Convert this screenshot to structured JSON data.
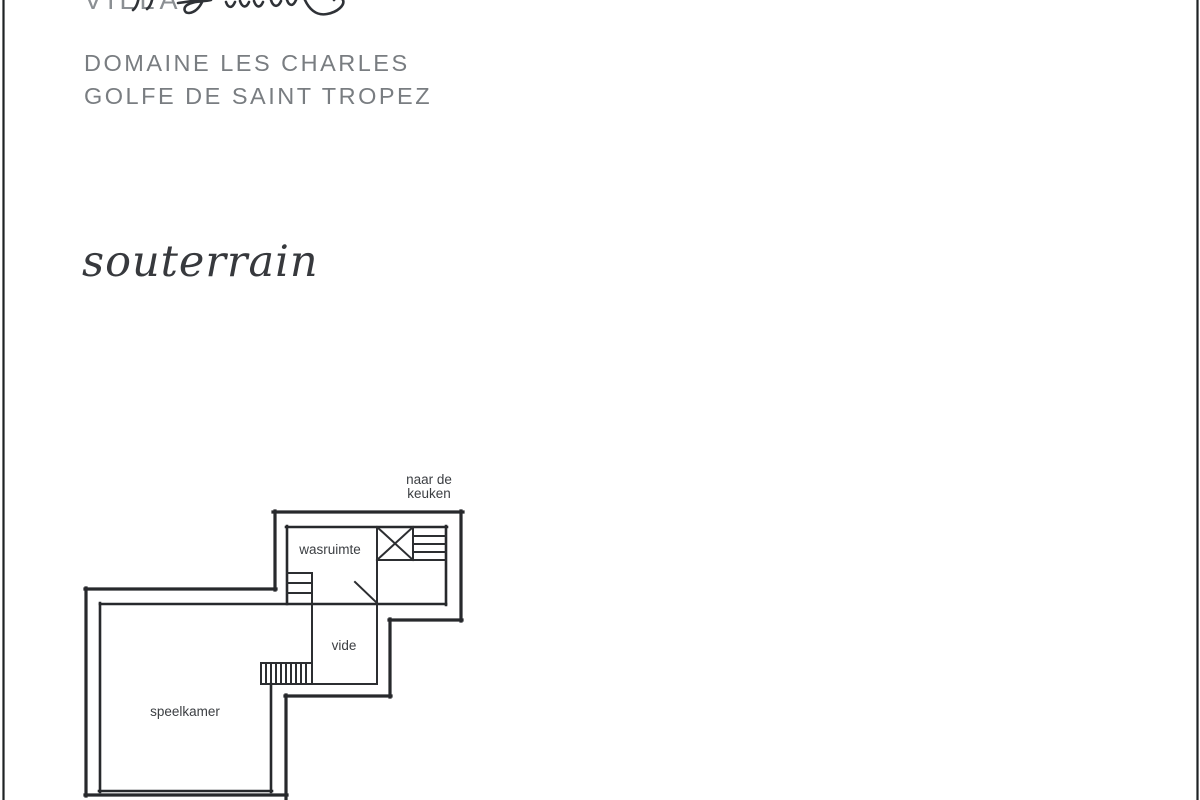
{
  "header": {
    "villa_prefix": "VILLA",
    "domaine": "DOMAINE LES CHARLES",
    "golfe": "GOLFE DE SAINT TROPEZ"
  },
  "floor_title": "souterrain",
  "plan": {
    "note_line1": "naar de",
    "note_line2": "keuken",
    "rooms": {
      "laundry": "wasruimte",
      "void": "vide",
      "playroom": "speelkamer"
    }
  },
  "colors": {
    "wall_line": "#27292c",
    "label_text": "#3b3e42",
    "subtitle_text": "#797d81",
    "villa_text": "#8b8f93",
    "page_border": "#1f2224",
    "background": "#ffffff"
  }
}
